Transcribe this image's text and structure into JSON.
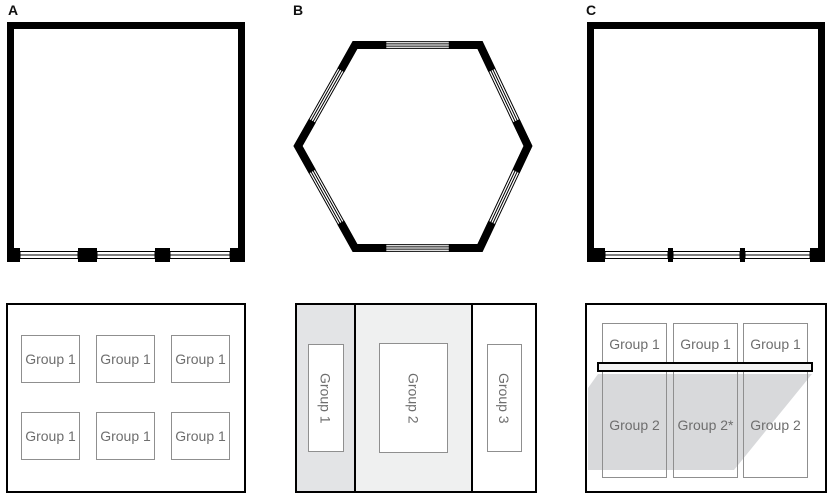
{
  "panels": {
    "a": {
      "label": "A",
      "layout_boxes": [
        "Group 1",
        "Group 1",
        "Group 1",
        "Group 1",
        "Group 1",
        "Group 1"
      ]
    },
    "b": {
      "label": "B",
      "columns": [
        "Group 1",
        "Group 2",
        "Group 3"
      ]
    },
    "c": {
      "label": "C",
      "row1": [
        "Group 1",
        "Group 1",
        "Group 1"
      ],
      "row2": [
        "Group 2",
        "Group 2*",
        "Group 2"
      ]
    }
  },
  "colors": {
    "wall": "#000000",
    "window-fill": "#ffffff",
    "box-border": "#8f8f8f",
    "box-text": "#6e6e6e",
    "panelb-col1": "#e3e4e6",
    "panelb-col2": "#eff0f0",
    "shade": "#d8d9db",
    "bar-fill": "#f2f2f2"
  }
}
